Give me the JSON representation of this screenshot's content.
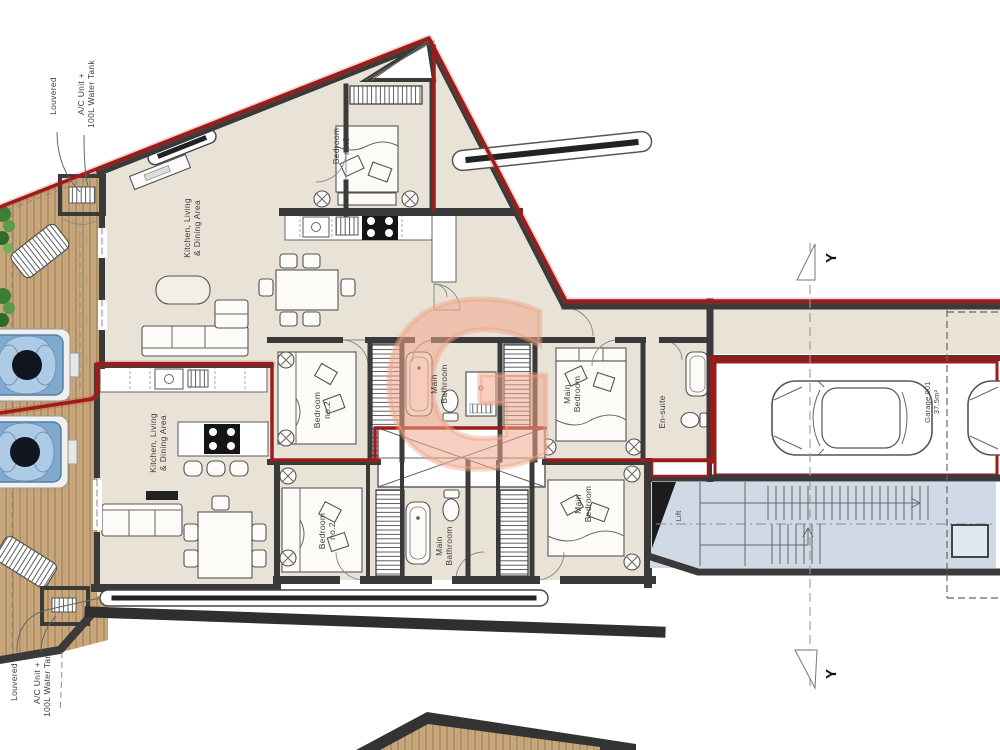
{
  "labels": {
    "upper": {
      "bedroom3_1": "Bedroom",
      "bedroom3_2": "no.3",
      "kitchen_1": "Kitchen, Living",
      "kitchen_2": "& Dining Area",
      "bedroom2_1": "Bedroom",
      "bedroom2_2": "no.2",
      "bath_1": "Main",
      "bath_2": "Bathroom",
      "bed_1": "Main",
      "bed_2": "Bedroom",
      "ensuite": "En-suite"
    },
    "lower": {
      "kitchen_1": "Kitchen, Living",
      "kitchen_2": "& Dining Area",
      "bedroom2_1": "Bedroom",
      "bedroom2_2": "no.2",
      "bath_1": "Main",
      "bath_2": "Bathroom",
      "bed_1": "Main",
      "bed_2": "Bedroom"
    },
    "garage_1": "Garage 001",
    "garage_2": "37.5m²",
    "lift": "Lift",
    "louvered_top": "Louvered",
    "louvered_bottom": "Louvered",
    "ac_1": "A/C Unit +",
    "ac_2": "100L Water Tank",
    "section_top": "Y",
    "section_bottom": "Y",
    "watermark": "G"
  },
  "colors": {
    "boundary_red": "#9E1B1B",
    "wall_dark": "#3A3A3A",
    "floor_beige": "#E9E2D6",
    "deck_wood": "#C9A87D",
    "stairs_blue": "#CFDAE6",
    "hot_tub_blue": "#7FA9CF",
    "watermark_salmon": "#F0A78E"
  }
}
